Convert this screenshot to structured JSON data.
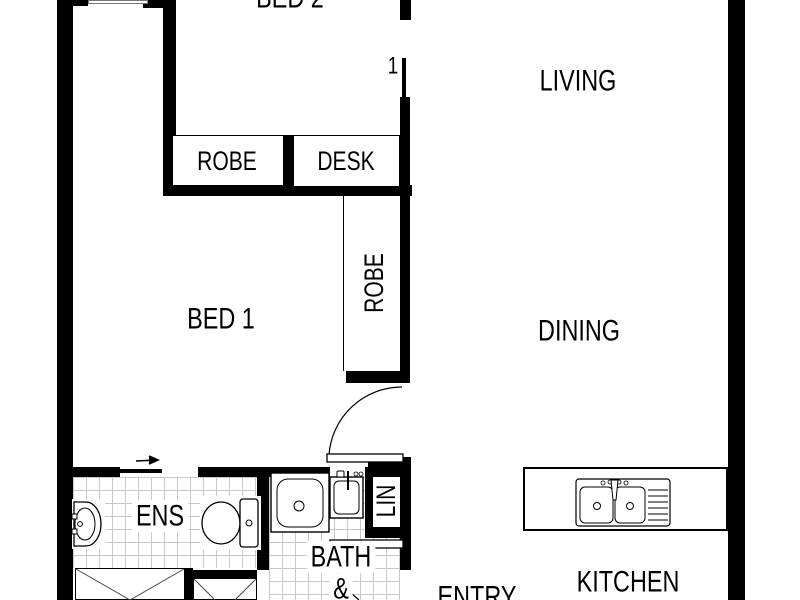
{
  "title": "apartment-floor-plan",
  "colors": {
    "wall": "#000000",
    "background": "#ffffff",
    "tile_line": "#c8c8c8",
    "fixture_line": "#000000"
  },
  "rooms": {
    "bed2": {
      "label": "BED 2"
    },
    "living": {
      "label": "LIVING"
    },
    "bed1": {
      "label": "BED 1"
    },
    "dining": {
      "label": "DINING"
    },
    "ens": {
      "label": "ENS"
    },
    "bath": {
      "label_line1": "BATH",
      "label_line2": "&"
    },
    "entry": {
      "label": "ENTRY"
    },
    "kitchen": {
      "label": "KITCHEN"
    }
  },
  "storage": {
    "bed2_robe": {
      "label": "ROBE"
    },
    "bed2_desk": {
      "label": "DESK"
    },
    "bed1_robe": {
      "label": "ROBE"
    },
    "linen": {
      "label": "LIN"
    }
  },
  "doors": {
    "bed2_door_label": "1"
  },
  "fixtures": [
    "ensuite-vanity-basin",
    "ensuite-toilet",
    "bathtub",
    "laundry-tub",
    "kitchen-double-sink",
    "sliding-door-arrow",
    "bed1-door-swing",
    "bath-door-swing",
    "wardrobe-cross-left",
    "wardrobe-cross-right"
  ]
}
